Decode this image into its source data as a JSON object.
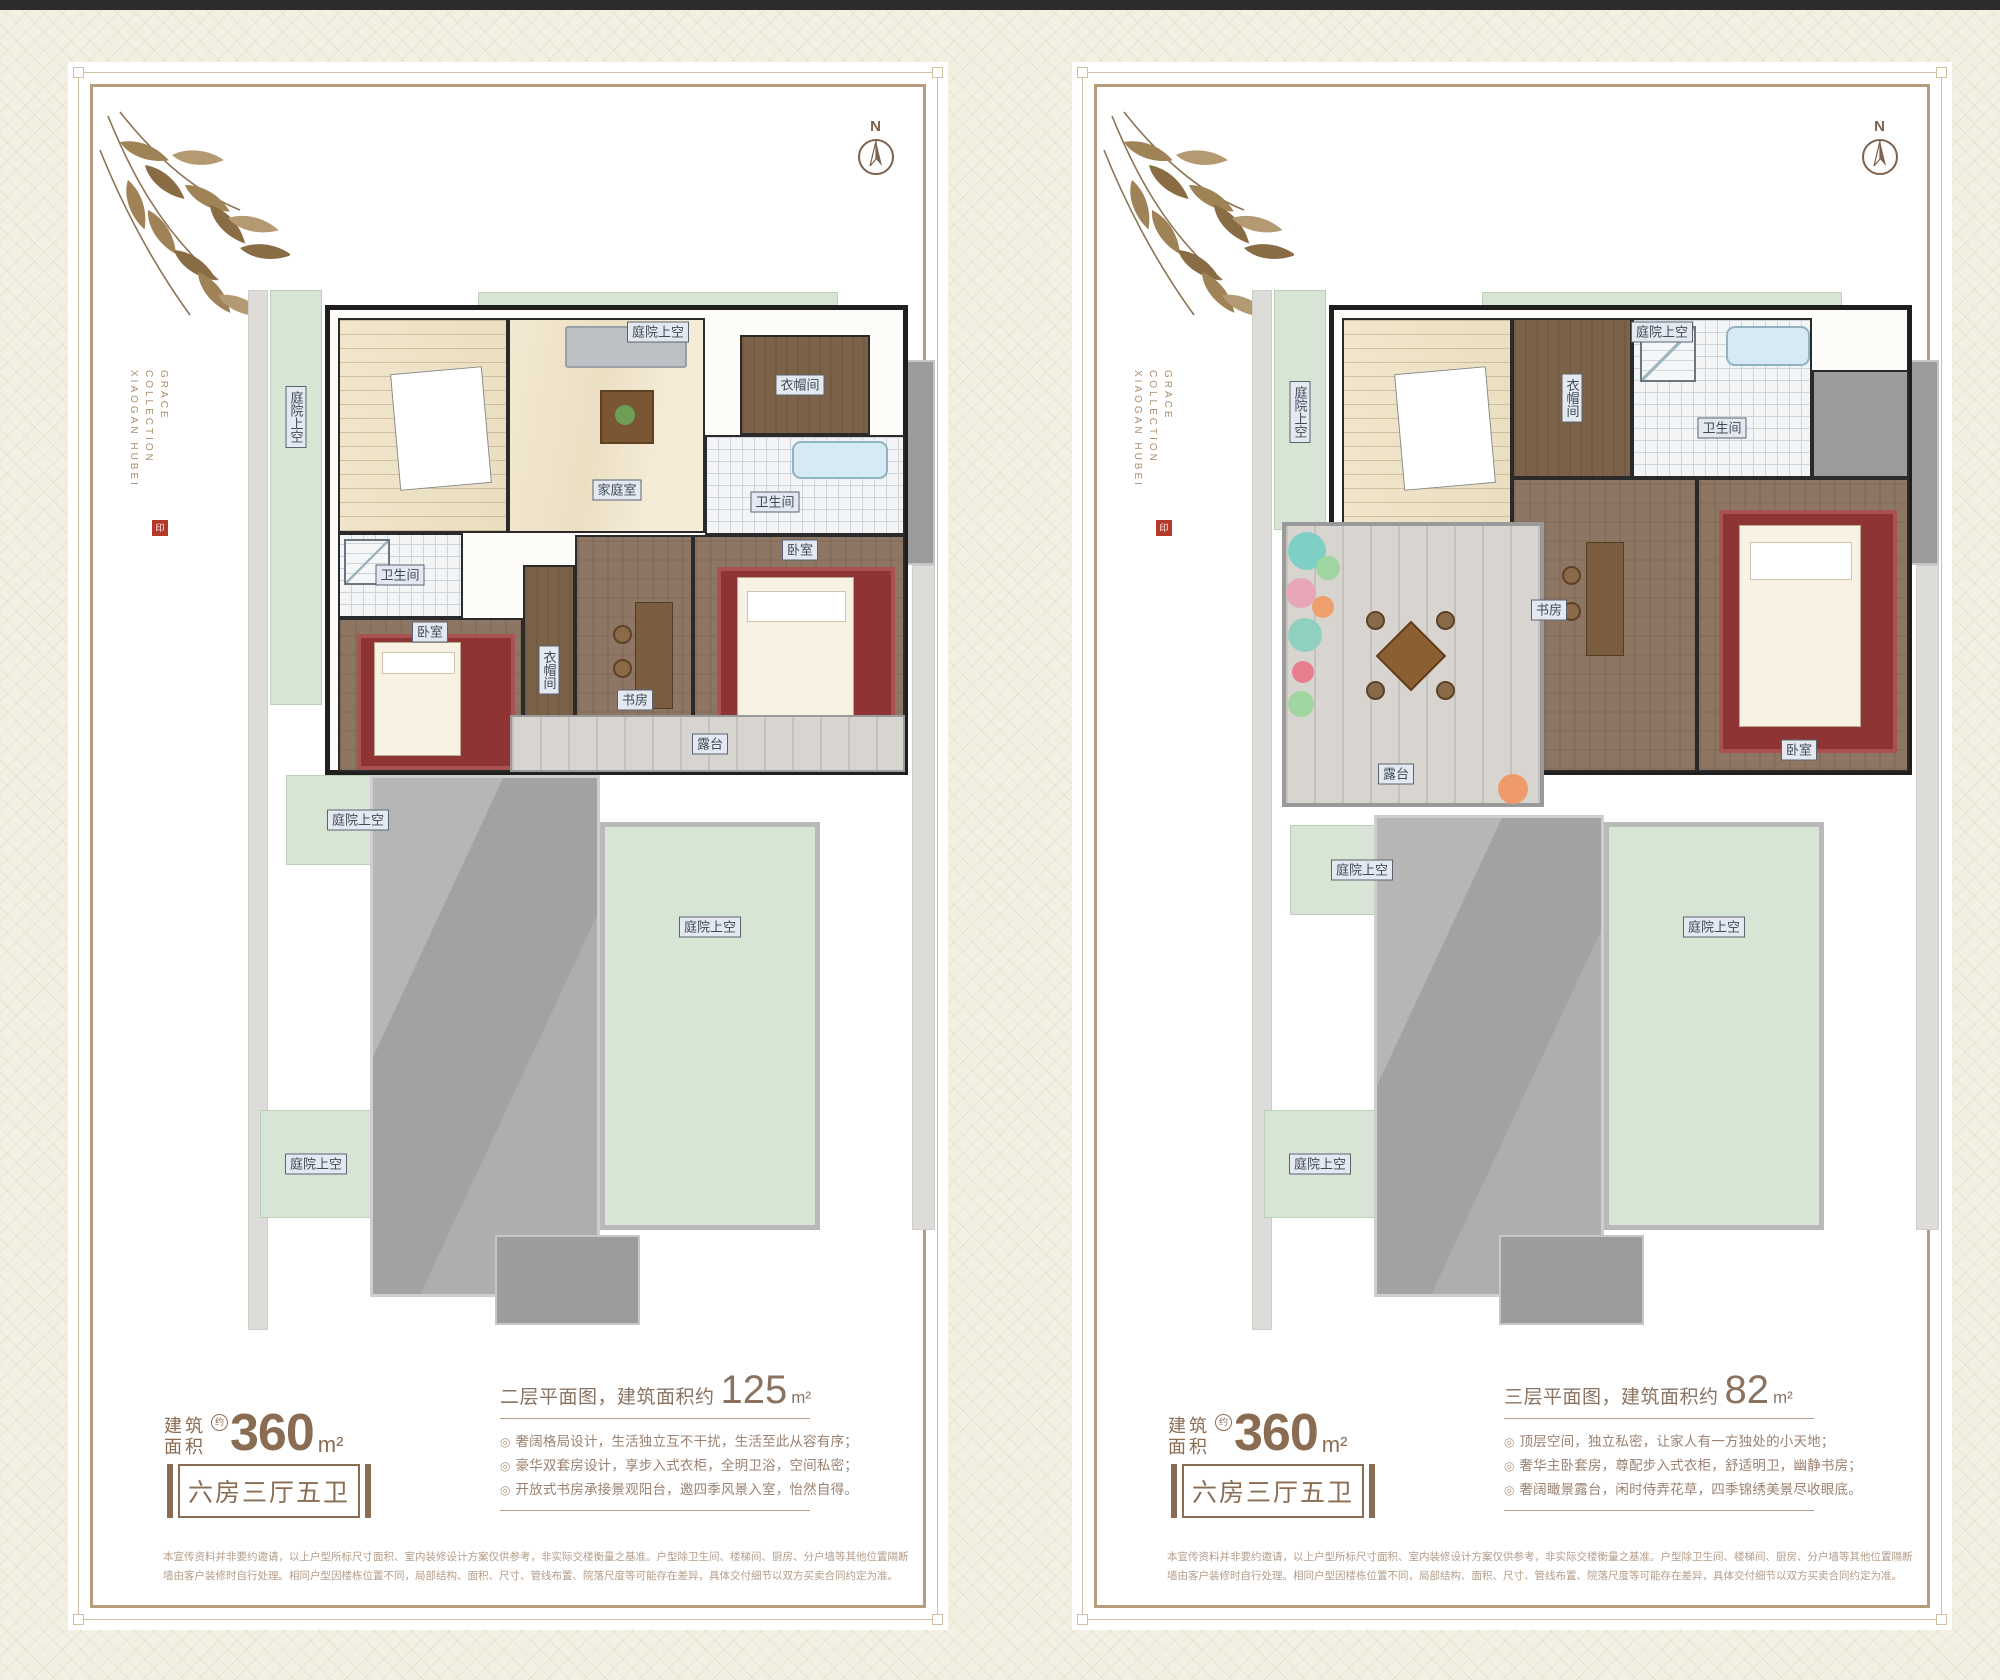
{
  "posters": [
    {
      "brand_vertical": {
        "line1": "GRACE COLLECTION",
        "line2": "XIAOGAN HUBEI"
      },
      "seal_glyph": "印",
      "compass_n": "N",
      "plan_labels": {
        "courtyard": "庭院上空",
        "family_room": "家庭室",
        "closet": "衣帽间",
        "bathroom": "卫生间",
        "bedroom": "卧室",
        "study": "书房",
        "terrace": "露台"
      },
      "floor_title": {
        "prefix": "二层平面图，建筑面积约",
        "value": "125",
        "unit": "m²"
      },
      "area_badge": {
        "label_line1": "建筑",
        "label_line2": "面积",
        "approx": "约",
        "value": "360",
        "unit": "m²",
        "layout": "六房三厅五卫"
      },
      "bullet_marker": "◎",
      "bullets": [
        "奢阔格局设计，生活独立互不干扰，生活至此从容有序；",
        "豪华双套房设计，享步入式衣柜，全明卫浴，空间私密；",
        "开放式书房承接景观阳台，邀四季风景入室，怡然自得。"
      ],
      "disclaimer": {
        "line1": "本宣传资料并非要约邀请，以上户型所标尺寸面积、室内装修设计方案仅供参考，非实际交楼衡量之基准。户型除卫生间、楼梯间、厨房、分户墙等其他位置隔断",
        "line2": "墙由客户装修时自行处理。相同户型因楼栋位置不同，局部结构、面积、尺寸、管线布置、院落尺度等可能存在差异，具体交付细节以双方买卖合同约定为准。"
      }
    },
    {
      "brand_vertical": {
        "line1": "GRACE COLLECTION",
        "line2": "XIAOGAN HUBEI"
      },
      "seal_glyph": "印",
      "compass_n": "N",
      "plan_labels": {
        "courtyard": "庭院上空",
        "closet": "衣帽间",
        "bathroom": "卫生间",
        "bedroom": "卧室",
        "study": "书房",
        "terrace": "露台"
      },
      "floor_title": {
        "prefix": "三层平面图，建筑面积约",
        "value": "82",
        "unit": "m²"
      },
      "area_badge": {
        "label_line1": "建筑",
        "label_line2": "面积",
        "approx": "约",
        "value": "360",
        "unit": "m²",
        "layout": "六房三厅五卫"
      },
      "bullet_marker": "◎",
      "bullets": [
        "顶层空间，独立私密，让家人有一方独处的小天地；",
        "奢华主卧套房，尊配步入式衣柜，舒适明卫，幽静书房；",
        "奢阔瞰景露台，闲时侍弄花草，四季锦绣美景尽收眼底。"
      ],
      "disclaimer": {
        "line1": "本宣传资料并非要约邀请，以上户型所标尺寸面积、室内装修设计方案仅供参考，非实际交楼衡量之基准。户型除卫生间、楼梯间、厨房、分户墙等其他位置隔断",
        "line2": "墙由客户装修时自行处理。相同户型因楼栋位置不同，局部结构、面积、尺寸、管线布置、院落尺度等可能存在差异，具体交付细节以双方买卖合同约定为准。"
      }
    }
  ]
}
